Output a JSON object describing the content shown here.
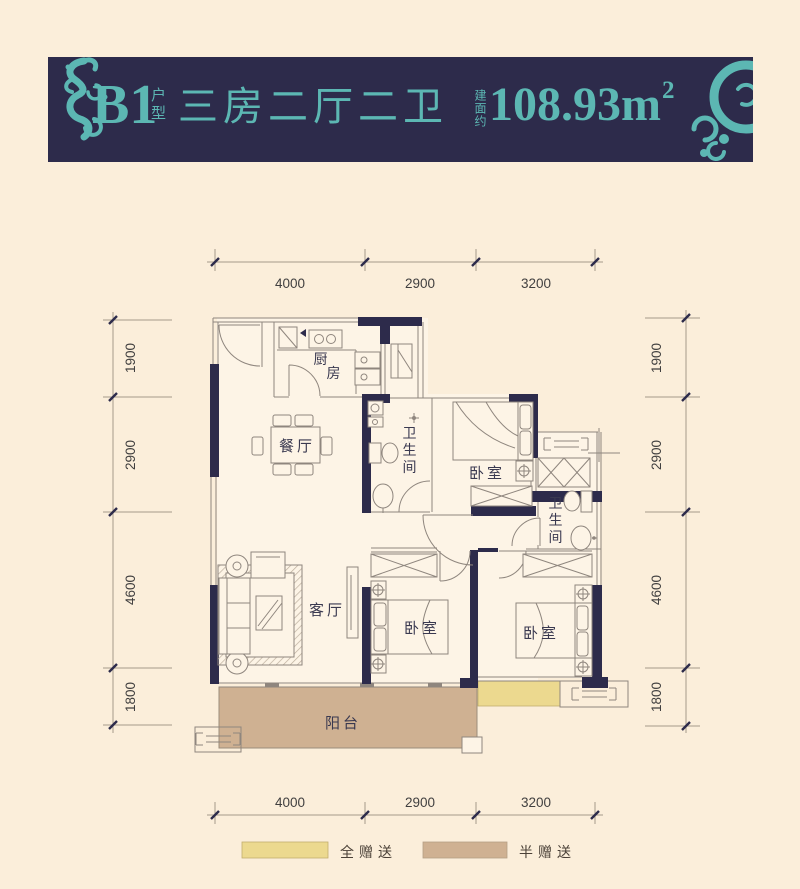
{
  "banner": {
    "unit": "B1",
    "unit_suffix": "户型",
    "layout": "三房二厅二卫",
    "area_label": "建面约",
    "area_value": "108.93",
    "area_unit": "m",
    "area_sup": "2"
  },
  "colors": {
    "banner_bg": "#2d2b4b",
    "accent_teal": "#5cb7b3",
    "wall": "#2d2b4b",
    "balcony_fill": "#cfb192",
    "gift_full": "#ecd98f",
    "gift_half": "#cfb192",
    "page_bg": "#fbeeda"
  },
  "dimensions": {
    "top": [
      "4000",
      "2900",
      "3200"
    ],
    "bottom": [
      "4000",
      "2900",
      "3200"
    ],
    "left": [
      "1900",
      "2900",
      "4600",
      "1800"
    ],
    "right": [
      "1900",
      "2900",
      "4600",
      "1800"
    ]
  },
  "rooms": {
    "kitchen": "厨房",
    "dining": "餐厅",
    "bath_top": "卫生间",
    "bedroom_top": "卧室",
    "bath_right": "卫生间",
    "living": "客厅",
    "bedroom_mid": "卧室",
    "bedroom_right": "卧室",
    "balcony": "阳台"
  },
  "legend": [
    {
      "label": "全赠送",
      "color": "#ecd98f"
    },
    {
      "label": "半赠送",
      "color": "#cfb192"
    }
  ]
}
